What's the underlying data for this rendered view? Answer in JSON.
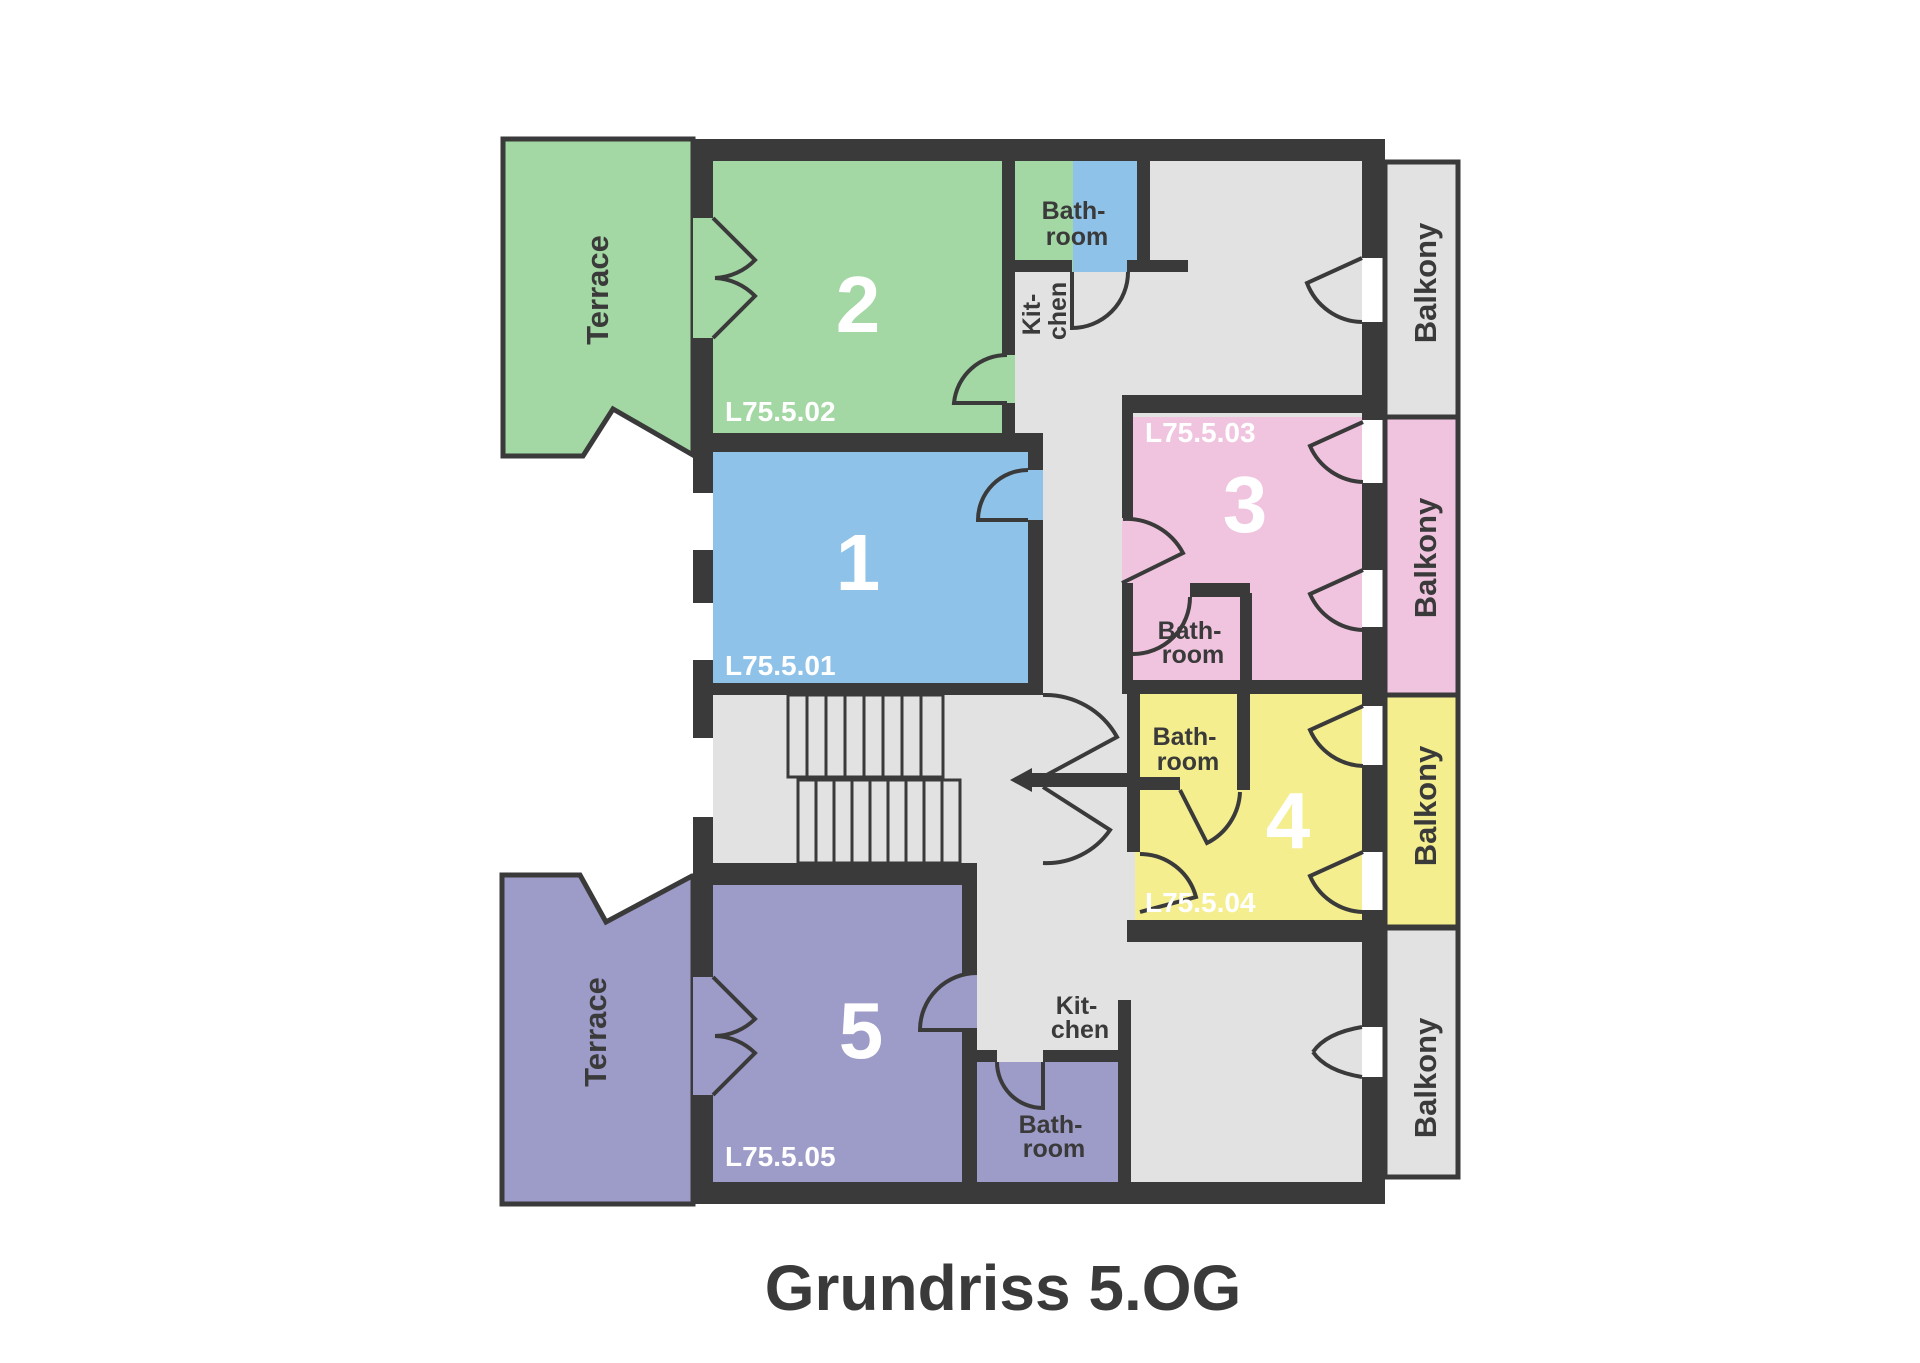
{
  "title": "Grundriss 5.OG",
  "floor_plan": {
    "apartments": [
      {
        "number": "1",
        "code": "L75.5.01",
        "color": "#8fc2e8"
      },
      {
        "number": "2",
        "code": "L75.5.02",
        "color": "#a3d7a3"
      },
      {
        "number": "3",
        "code": "L75.5.03",
        "color": "#f0c4de"
      },
      {
        "number": "4",
        "code": "L75.5.04",
        "color": "#f4ee8e"
      },
      {
        "number": "5",
        "code": "L75.5.05",
        "color": "#9d9bc7"
      }
    ],
    "labels": {
      "terrace": "Terrace",
      "balcony": "Balkony",
      "bath1": "Bath-",
      "bath2": "room",
      "kit1": "Kit-",
      "kit2": "chen"
    },
    "colors": {
      "wall": "#3a3a3a",
      "common_area": "#e2e2e2",
      "text_dark": "#3a3a3a",
      "text_light": "#ffffff"
    }
  }
}
